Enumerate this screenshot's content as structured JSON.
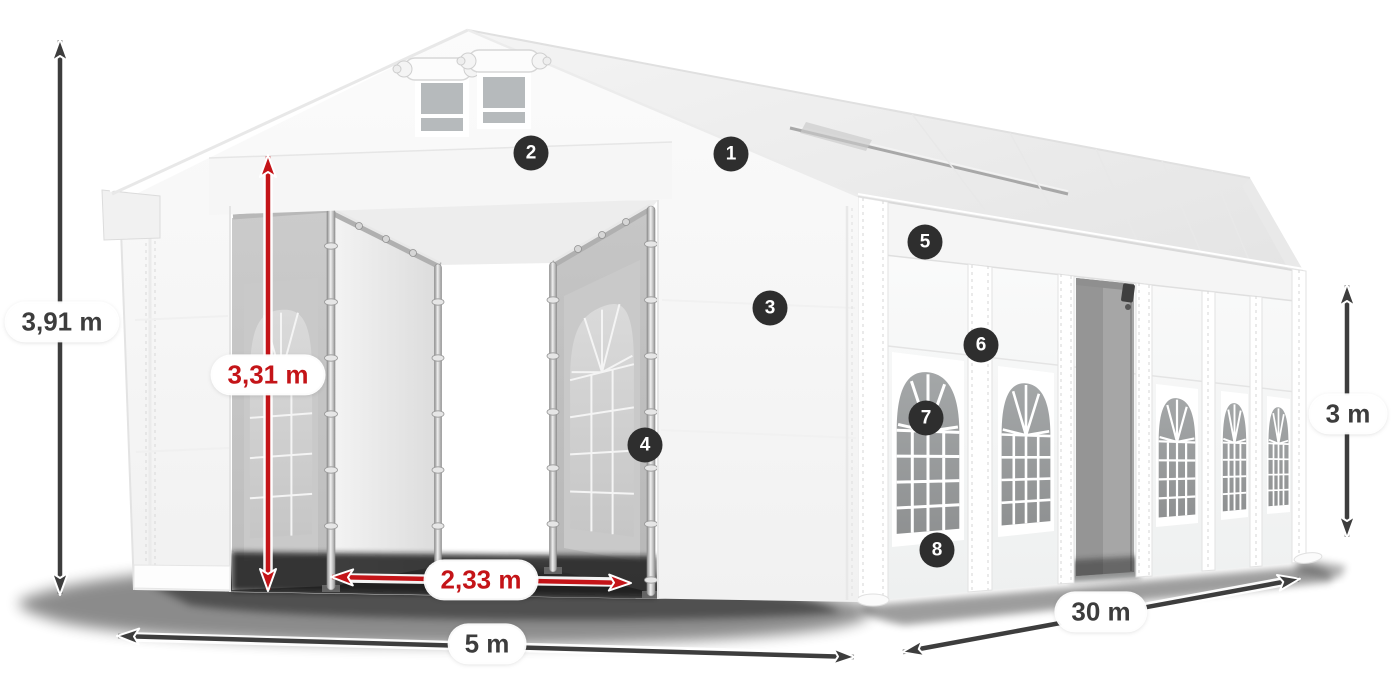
{
  "diagram": {
    "dimensions": {
      "total_height": "3,91 m",
      "entrance_height": "3,31 m",
      "entrance_width": "2,33 m",
      "front_width": "5 m",
      "length": "30 m",
      "side_height": "3 m"
    },
    "markers": [
      {
        "number": "1"
      },
      {
        "number": "2"
      },
      {
        "number": "3"
      },
      {
        "number": "4"
      },
      {
        "number": "5"
      },
      {
        "number": "6"
      },
      {
        "number": "7"
      },
      {
        "number": "8"
      }
    ]
  },
  "colors": {
    "background": "#ffffff",
    "dimension_dark": "#3d3d3d",
    "dimension_red": "#c41418",
    "marker_background": "#2e2e2e",
    "marker_text": "#ffffff",
    "label_background": "#ffffff",
    "tent_white": "#f8f8f8",
    "window_glass": "#9b9b9b"
  }
}
